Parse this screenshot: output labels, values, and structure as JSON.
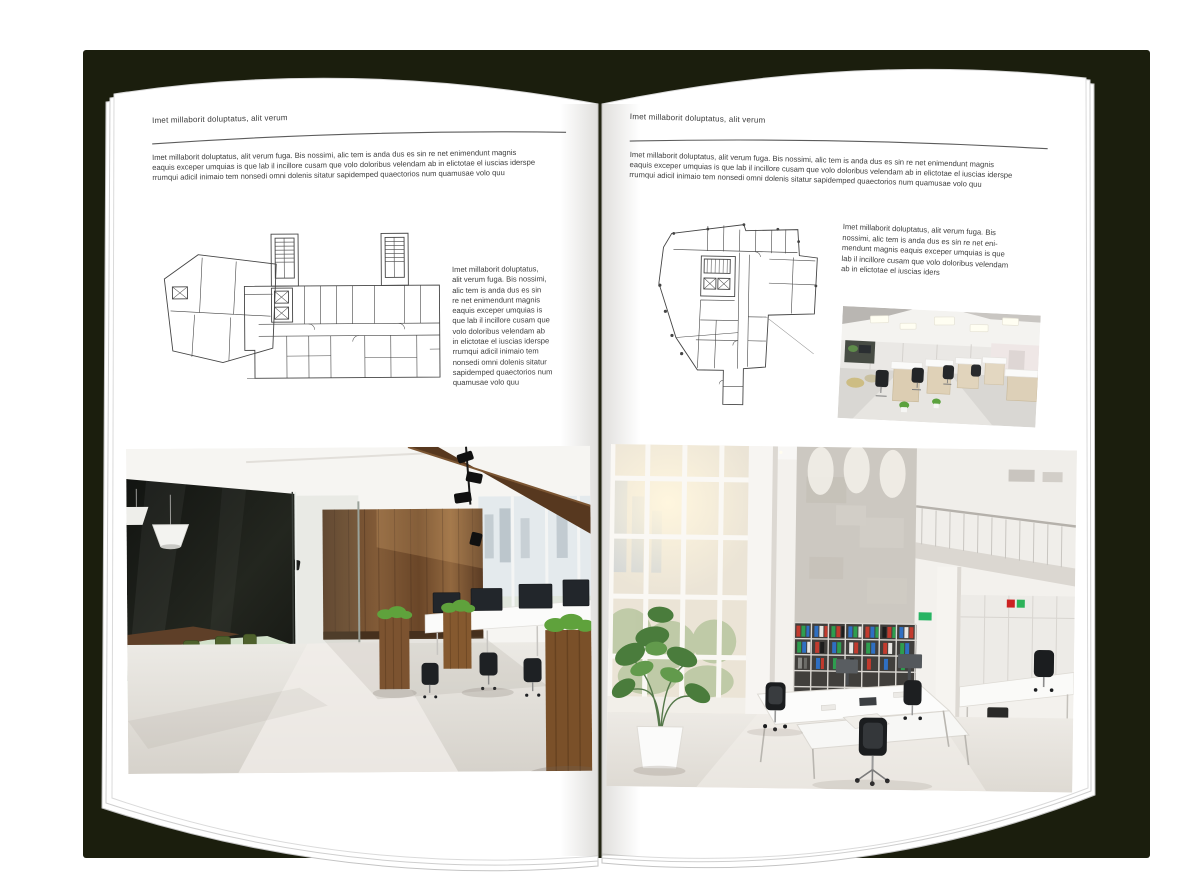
{
  "book": {
    "shadow_color": "#1b1e0d",
    "page_color": "#ffffff",
    "text_color": "#3d3d3d",
    "rule_color": "#5c5c5c"
  },
  "left_page": {
    "header": "Imet millaborit doluptatus, alit verum",
    "intro": "Imet millaborit doluptatus, alit verum fuga. Bis nossimi, alic tem is anda dus es sin re net enimendunt magnis\neaquis exceper umquias is que lab il incillore cusam que volo doloribus velendam ab in elictotae el iuscias iderspe\nrrumqui adicil inimaio tem nonsedi omni dolenis sitatur sapidemped quaectorios num quamusae volo quu",
    "side_text": "Imet millaborit doluptatus,\nalit verum fuga. Bis nossimi,\nalic tem is anda dus es sin\nre net enimendunt magnis\neaquis exceper umquias is\nque lab il incillore cusam que\nvolo doloribus velendam ab\nin elictotae el iuscias iderspe\nrrumqui adicil inimaio tem\nnonsedi omni dolenis sitatur\nsapidemped quaectorios num\nquamusae volo quu",
    "floorplan_alt": "floor plan — wide block with two stair towers",
    "photo_alt": "loft office with glass meeting room and wood wall"
  },
  "right_page": {
    "header": "Imet millaborit doluptatus, alit verum",
    "intro": "Imet millaborit doluptatus, alit verum fuga. Bis nossimi, alic tem is anda dus es sin re net enimendunt magnis\neaquis exceper umquias is que lab il incillore cusam que volo doloribus velendam ab in elictotae el iuscias iderspe\nrrumqui adicil inimaio tem nonsedi omni dolenis sitatur sapidemped quaectorios num quamusae volo quu",
    "body_text": "Imet millaborit doluptatus, alit verum fuga. Bis\nnossimi, alic tem is anda dus es sin re net eni-\nmendunt magnis eaquis exceper umquias is que\nlab il incillore cusam que volo doloribus velendam\nab in elictotae el iuscias iders",
    "floorplan_alt": "floor plan — irregular tower footprint",
    "photo_small_alt": "open-plan office with cubicle workstations",
    "photo_alt": "double-height white office with window wall and shelves"
  }
}
